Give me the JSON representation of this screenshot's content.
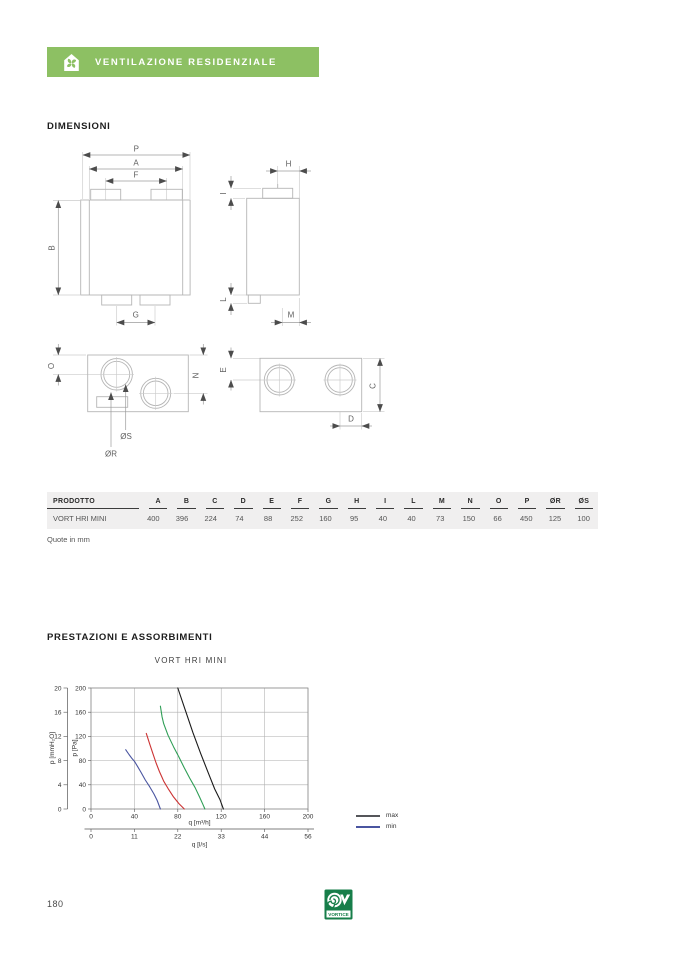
{
  "banner": {
    "label": "VENTILAZIONE RESIDENZIALE",
    "color": "#8dc063",
    "icon": "house-fan-icon"
  },
  "sections": {
    "dimensions_title": "DIMENSIONI",
    "performance_title": "PRESTAZIONI E ASSORBIMENTI"
  },
  "drawing": {
    "labels": {
      "p": "P",
      "a": "A",
      "f": "F",
      "b": "B",
      "g": "G",
      "h": "H",
      "i": "I",
      "l": "L",
      "m": "M",
      "o": "O",
      "n": "N",
      "os": "ØS",
      "or": "ØR",
      "e": "E",
      "c": "C",
      "d": "D"
    }
  },
  "table": {
    "headers": [
      "PRODOTTO",
      "A",
      "B",
      "C",
      "D",
      "E",
      "F",
      "G",
      "H",
      "I",
      "L",
      "M",
      "N",
      "O",
      "P",
      "ØR",
      "ØS"
    ],
    "rows": [
      [
        "VORT HRI MINI",
        "400",
        "396",
        "224",
        "74",
        "88",
        "252",
        "160",
        "95",
        "40",
        "40",
        "73",
        "150",
        "66",
        "450",
        "125",
        "100"
      ]
    ],
    "note": "Quote in mm"
  },
  "chart_data": {
    "type": "line",
    "title": "VORT HRI MINI",
    "xlabel": "q [m³/h]",
    "xlabel2": "q [l/s]",
    "ylabel": "p [Pa]",
    "ylabel2": "p [mmH₂O]",
    "xlim": [
      0,
      200
    ],
    "ylim": [
      0,
      200
    ],
    "x_ticks": [
      0,
      40,
      80,
      120,
      160,
      200
    ],
    "x2_tick_labels": [
      "0",
      "11",
      "22",
      "33",
      "44",
      "56"
    ],
    "y_ticks": [
      0,
      40,
      80,
      120,
      160,
      200
    ],
    "y2_ticks": [
      0,
      4,
      8,
      12,
      16,
      20
    ],
    "grid": true,
    "legend_position": "right-bottom",
    "legend": [
      {
        "name": "max",
        "color": "#55565a"
      },
      {
        "name": "min",
        "color": "#4a55a0"
      }
    ],
    "series": [
      {
        "name": "max",
        "color": "#1a1a1a",
        "points": [
          [
            80,
            200
          ],
          [
            87,
            163
          ],
          [
            94,
            126
          ],
          [
            101,
            92
          ],
          [
            108,
            60
          ],
          [
            114,
            33
          ],
          [
            119,
            15
          ],
          [
            122,
            0
          ]
        ]
      },
      {
        "name": "speed-3",
        "color": "#2f9e56",
        "points": [
          [
            64,
            170
          ],
          [
            65.5,
            152
          ],
          [
            67,
            141
          ],
          [
            71,
            122
          ],
          [
            76,
            103
          ],
          [
            81,
            86
          ],
          [
            86,
            68
          ],
          [
            91,
            51
          ],
          [
            96,
            35
          ],
          [
            100,
            20
          ],
          [
            103,
            8
          ],
          [
            105,
            0
          ]
        ]
      },
      {
        "name": "speed-2",
        "color": "#cc3333",
        "points": [
          [
            51,
            125
          ],
          [
            54,
            108
          ],
          [
            57,
            92
          ],
          [
            60,
            76
          ],
          [
            63,
            62
          ],
          [
            65.5,
            52
          ],
          [
            67,
            46
          ],
          [
            71,
            34
          ],
          [
            76,
            20
          ],
          [
            81,
            9
          ],
          [
            86,
            0
          ]
        ]
      },
      {
        "name": "min",
        "color": "#4a55a0",
        "points": [
          [
            32,
            98
          ],
          [
            35,
            90
          ],
          [
            38,
            83
          ],
          [
            40,
            79
          ],
          [
            43,
            70
          ],
          [
            46,
            61
          ],
          [
            50,
            48
          ],
          [
            54,
            37
          ],
          [
            58,
            25
          ],
          [
            61,
            14
          ],
          [
            64,
            0
          ]
        ]
      }
    ]
  },
  "footer": {
    "page_number": "180",
    "logo_text": "VORTICE",
    "logo_color": "#177e4a"
  }
}
